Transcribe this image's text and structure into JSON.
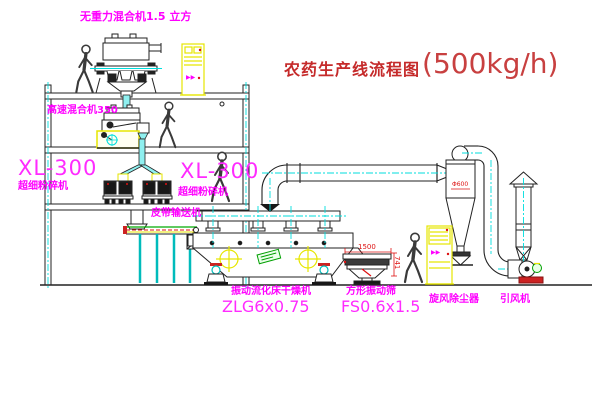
{
  "title": {
    "text": "农药生产线流程图",
    "capacity": "(500kg/h)"
  },
  "labels": {
    "gravity_mixer": "无重力混合机1.5 立方",
    "high_speed_mixer": "高速混合机350",
    "crusher_left": {
      "model": "XL-300",
      "name": "超细粉碎机"
    },
    "crusher_right": {
      "model": "XL-300",
      "name": "超细粉碎机"
    },
    "belt_conveyor": "皮带输送机",
    "dryer": {
      "name": "振动流化床干燥机",
      "model": "ZLG6x0.75"
    },
    "screen": {
      "name": "方形振动筛",
      "model": "FS0.6x1.5"
    },
    "cyclone": "旋风除尘器",
    "fan": "引风机"
  },
  "dimensions": {
    "screen_length": "1500",
    "screen_height": "741",
    "cyclone_diameter": "Φ600"
  },
  "marks": {
    "cabinet_top": "▶▶",
    "cabinet_right": "▶▶"
  },
  "colors": {
    "label_magenta": "#ff00ff",
    "title_red": "#c52a2a",
    "dimension_red": "#dd1111",
    "centerline_cyan": "#00dede",
    "pipe_cyan": "#8ff0f0",
    "highlight_yellow": "#e6e600",
    "accent_green": "#00a000",
    "line_dark": "#222222"
  }
}
